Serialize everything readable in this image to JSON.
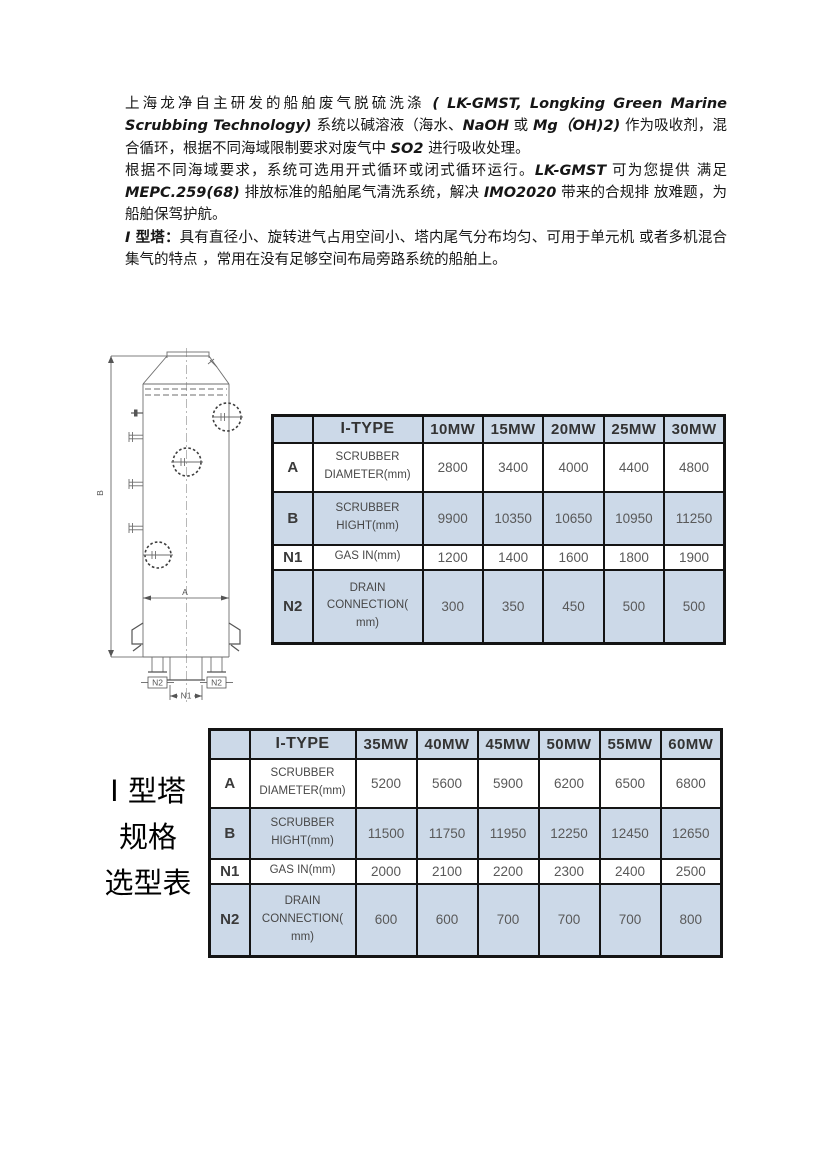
{
  "document": {
    "intro": {
      "p1": [
        {
          "t": "上海龙净自主研发的船舶废气脱硫洗涤 ",
          "s": "cn"
        },
        {
          "t": "( LK-GMST, Longking Green Marine Scrubbing Technology) ",
          "s": "en"
        },
        {
          "t": "系统以碱溶液（海水、",
          "s": "cn"
        },
        {
          "t": "NaOH",
          "s": "en"
        },
        {
          "t": " 或 ",
          "s": "cn"
        },
        {
          "t": "Mg（OH)2)",
          "s": "en"
        },
        {
          "t": " 作为吸收剂，混合循环，根据不同海域限制要求对废气中 ",
          "s": "cn"
        },
        {
          "t": "SO2",
          "s": "en"
        },
        {
          "t": " 进行吸收处理。",
          "s": "cn"
        }
      ],
      "p2": [
        {
          "t": "根据不同海域要求，系统可选用开式循环或闭式循环运行。",
          "s": "cn"
        },
        {
          "t": "LK-GMST",
          "s": "en"
        },
        {
          "t": " 可为您提供 满足 ",
          "s": "cn"
        },
        {
          "t": "MEPC.259(68)",
          "s": "en"
        },
        {
          "t": " 排放标准的船舶尾气清洗系统，解决 ",
          "s": "cn"
        },
        {
          "t": "IMO2020",
          "s": "en"
        },
        {
          "t": " 带来的合规排 放难题，为船舶保驾护航。",
          "s": "cn"
        }
      ],
      "p3": [
        {
          "t": "I",
          "s": "en"
        },
        {
          "t": " 型塔：",
          "s": "cnb"
        },
        {
          "t": "具有直径小、旋转进气占用空间小、塔内尾气分布均匀、可用于单元机 或者多机混合集气的特点 ，常用在没有足够空间布局旁路系统的船舶上。",
          "s": "cn"
        }
      ]
    },
    "side_title": {
      "lines": [
        "I 型塔",
        "规格",
        "选型表"
      ]
    },
    "drawing": {
      "dim_a": "A",
      "dim_b": "B",
      "nozzle_n1": "N1",
      "nozzle_n2_left": "N2",
      "nozzle_n2_right": "N2"
    },
    "tables": [
      {
        "corner": "",
        "type_header": "I-TYPE",
        "columns": [
          "10MW",
          "15MW",
          "20MW",
          "25MW",
          "30MW"
        ],
        "rows": [
          {
            "label": "A",
            "name": "SCRUBBER DIAMETER(mm)",
            "values": [
              "2800",
              "3400",
              "4000",
              "4400",
              "4800"
            ]
          },
          {
            "label": "B",
            "name": "SCRUBBER HIGHT(mm)",
            "values": [
              "9900",
              "10350",
              "10650",
              "10950",
              "11250"
            ]
          },
          {
            "label": "N1",
            "name": "GAS IN(mm)",
            "values": [
              "1200",
              "1400",
              "1600",
              "1800",
              "1900"
            ]
          },
          {
            "label": "N2",
            "name": "DRAIN CONNECTION( mm)",
            "values": [
              "300",
              "350",
              "450",
              "500",
              "500"
            ]
          }
        ]
      },
      {
        "corner": "",
        "type_header": "I-TYPE",
        "columns": [
          "35MW",
          "40MW",
          "45MW",
          "50MW",
          "55MW",
          "60MW"
        ],
        "rows": [
          {
            "label": "A",
            "name": "SCRUBBER DIAMETER(mm)",
            "values": [
              "5200",
              "5600",
              "5900",
              "6200",
              "6500",
              "6800"
            ]
          },
          {
            "label": "B",
            "name": "SCRUBBER HIGHT(mm)",
            "values": [
              "11500",
              "11750",
              "11950",
              "12250",
              "12450",
              "12650"
            ]
          },
          {
            "label": "N1",
            "name": "GAS IN(mm)",
            "values": [
              "2000",
              "2100",
              "2200",
              "2300",
              "2400",
              "2500"
            ]
          },
          {
            "label": "N2",
            "name": "DRAIN CONNECTION( mm)",
            "values": [
              "600",
              "600",
              "700",
              "700",
              "700",
              "800"
            ]
          }
        ]
      }
    ],
    "colors": {
      "table_fill": "#ccd9e8",
      "table_border": "#141414"
    }
  }
}
